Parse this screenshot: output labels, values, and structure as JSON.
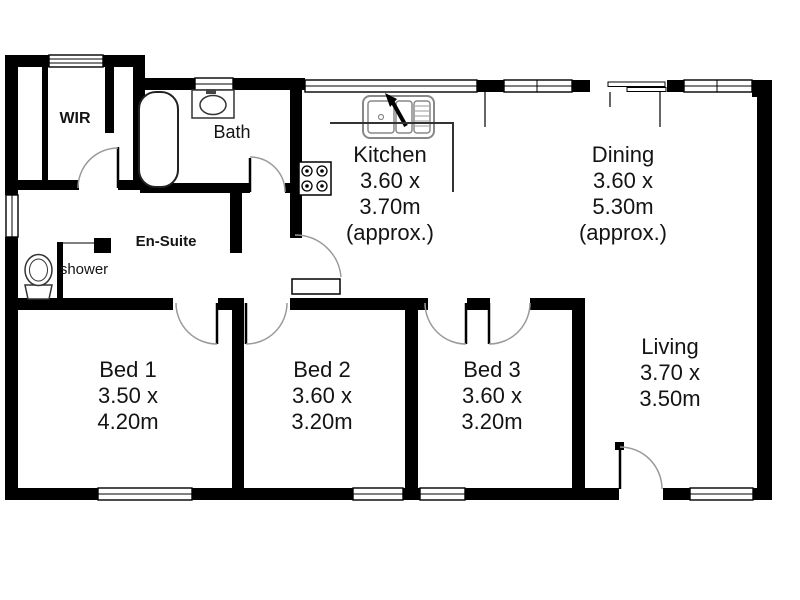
{
  "floor_plan": {
    "rooms": [
      {
        "key": "kitchen",
        "name": "Kitchen",
        "line2": "3.60 x",
        "line3": "3.70m",
        "line4": "(approx.)"
      },
      {
        "key": "dining",
        "name": "Dining",
        "line2": "3.60 x",
        "line3": "5.30m",
        "line4": "(approx.)"
      },
      {
        "key": "living",
        "name": "Living",
        "line2": "3.70 x",
        "line3": "3.50m"
      },
      {
        "key": "bed1",
        "name": "Bed 1",
        "line2": "3.50 x",
        "line3": "4.20m"
      },
      {
        "key": "bed2",
        "name": "Bed 2",
        "line2": "3.60 x",
        "line3": "3.20m"
      },
      {
        "key": "bed3",
        "name": "Bed 3",
        "line2": "3.60 x",
        "line3": "3.20m"
      }
    ],
    "areas": {
      "wir": "WIR",
      "bath": "Bath",
      "ensuite": "En-Suite",
      "shower": "shower"
    },
    "fixtures": [
      "bathtub",
      "vanity-basin",
      "toilet",
      "shower-enclosure",
      "kitchen-sink",
      "stove",
      "sliding-door"
    ],
    "colors": {
      "wall": "#000000",
      "background": "#ffffff",
      "door_arc": "#9a9a9a",
      "fixture_stroke": "#444444"
    }
  }
}
